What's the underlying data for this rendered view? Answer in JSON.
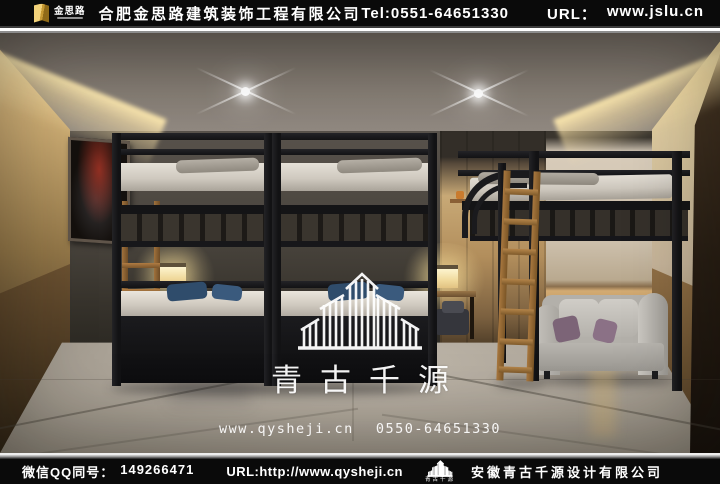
{
  "header": {
    "brand_mark": "金思路",
    "company": "合肥金思路建筑装饰工程有限公司",
    "tel": "Tel:0551-64651330",
    "url_label": "URL：",
    "url_value": "www.jslu.cn"
  },
  "watermark": {
    "brand": "青古千源",
    "website": "www.qysheji.cn",
    "phone": "0550-64651330"
  },
  "footer": {
    "wechat_qq_label": "微信QQ同号：",
    "wechat_qq_number": "149266471",
    "url": "URL:http://www.qysheji.cn",
    "logo_text": "青古千源",
    "company": "安徽青古千源设计有限公司"
  },
  "icons": {
    "header_logo": "gold-book-icon",
    "watermark_logo": "skyline-outline-logo-icon",
    "footer_logo": "skyline-logo-icon"
  },
  "colors": {
    "bar_background": "#0a0a0a",
    "text_white": "#ffffff",
    "brand_gold": "#d9b04a",
    "wood_wainscot": "#a5804e",
    "wall_grey": "#57514a",
    "pillow_blue": "#2f4c6b",
    "sofa_grey": "#b7b4ae",
    "cove_light": "#ffeab0"
  }
}
